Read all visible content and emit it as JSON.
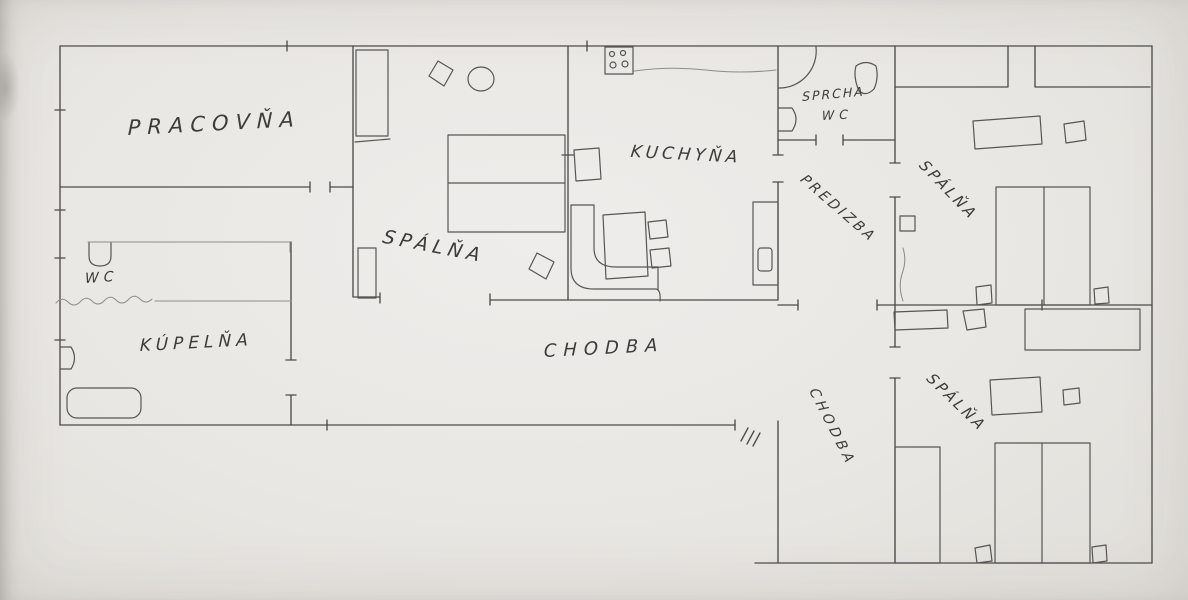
{
  "colors": {
    "paper": "#e9e7e3",
    "pencil": "#4d4c4a",
    "pencil_light": "#8f8d89",
    "label_text": "#3d3c39"
  },
  "labels": {
    "pracovna": "PRACOVŇA",
    "spalna_middle": "SPÁLŇA",
    "kuchyna": "KUCHYŇA",
    "sprcha": "SPRCHA",
    "sprcha_wc": "WC",
    "predizba": "PREDIZBA",
    "spalna_top_right": "SPÁLŇA",
    "wc": "WC",
    "kupelna": "KÚPELŇA",
    "chodba_main": "CHODBA",
    "chodba_right": "CHODBA",
    "spalna_bottom_right": "SPÁLŇA"
  }
}
